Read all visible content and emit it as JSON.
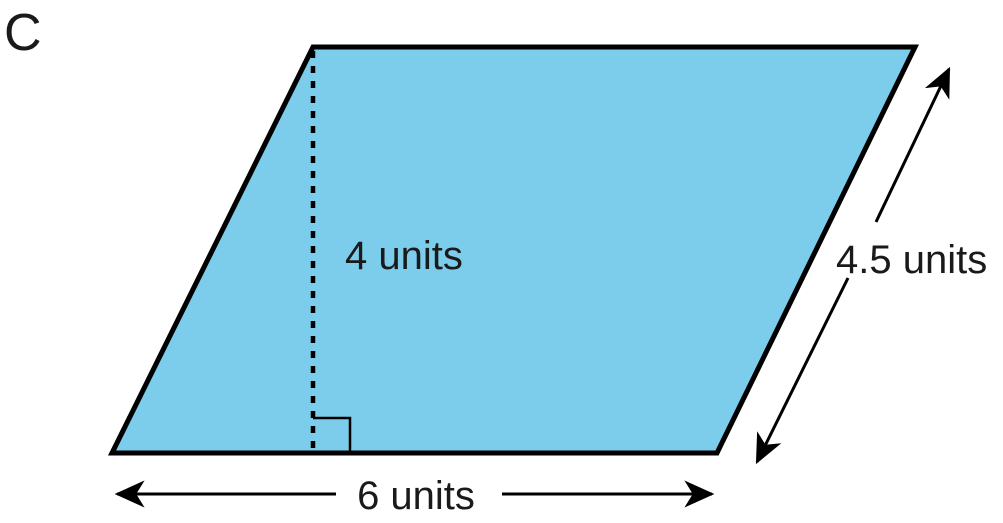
{
  "figure": {
    "label": "C",
    "shape": "parallelogram",
    "height": {
      "value": 4,
      "label": "4 units"
    },
    "slant_side": {
      "value": 4.5,
      "label": "4.5 units"
    },
    "base": {
      "value": 6,
      "label": "6 units"
    }
  },
  "colors": {
    "shape_fill": "#7bcdeb",
    "shape_stroke": "#000000",
    "text": "#1a1a1a"
  }
}
